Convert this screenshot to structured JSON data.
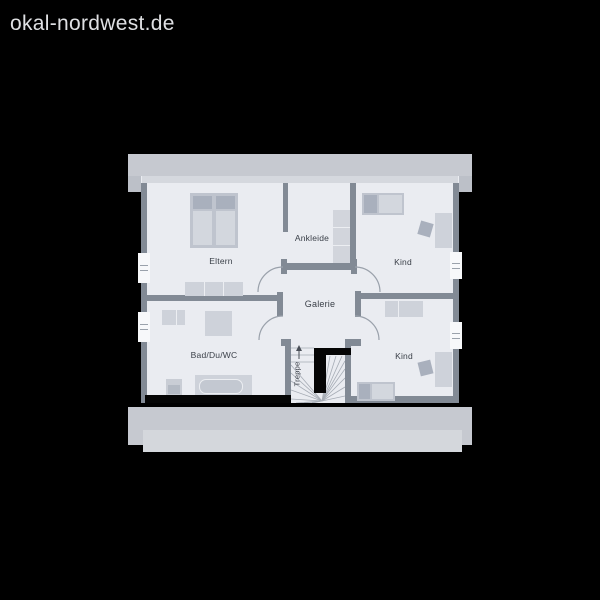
{
  "watermark": "okal-nordwest.de",
  "plan": {
    "labels": {
      "eltern": "Eltern",
      "ankleide": "Ankleide",
      "kind_top": "Kind",
      "galerie": "Galerie",
      "bad": "Bad/Du/WC",
      "kind_bottom": "Kind",
      "treppe": "Treppe"
    },
    "colors": {
      "background": "#000000",
      "watermark_text": "#dfe0e3",
      "eave_band": "#c6c9d0",
      "eave_light": "#d4d7dc",
      "floor": "#eaecf1",
      "wall": "#828a95",
      "furniture": "#ced2da",
      "furniture_dark": "#a9b0bd",
      "accent_black": "#050505",
      "label_text": "#3b4049"
    }
  }
}
